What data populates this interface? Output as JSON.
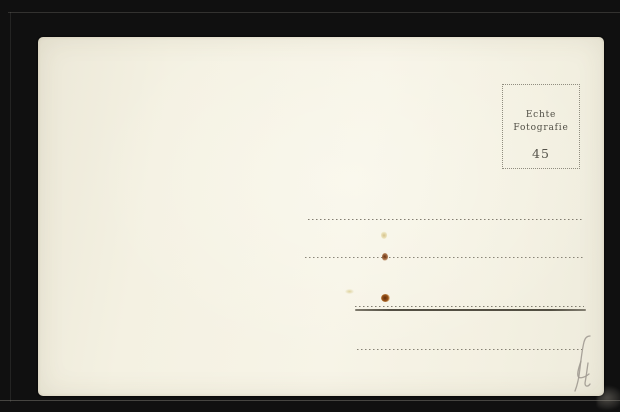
{
  "scene": {
    "description": "Scanned back of a blank vintage photo postcard on a black album background",
    "background_color": "#101010",
    "card_color": "#f5f2e3"
  },
  "stamp_box": {
    "label_line1": "Echte",
    "label_line2": "Fotografie",
    "number": "45",
    "border_color": "#908d7f",
    "text_color": "#504e45"
  },
  "address_lines": {
    "count": 4,
    "dot_color": "#6c675a",
    "underline_color": "#4a463a"
  },
  "handwriting": {
    "text": "(4",
    "medium": "pencil",
    "color": "#a09a91"
  },
  "stains": {
    "brown": "#6d3310",
    "yellow": "#d6c46e"
  }
}
